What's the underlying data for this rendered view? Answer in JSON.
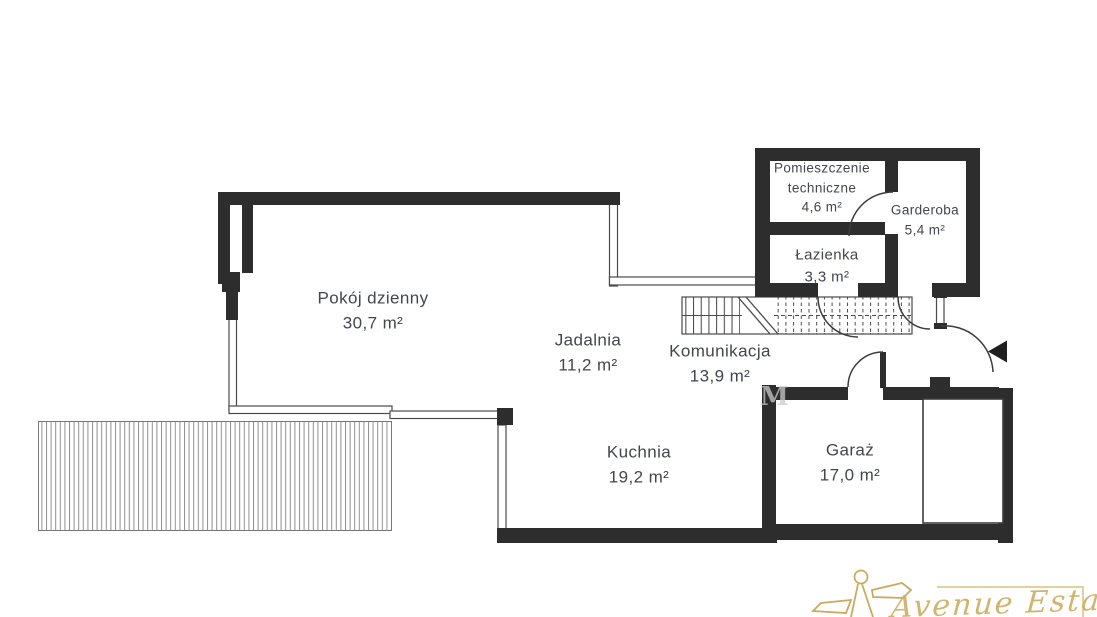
{
  "plan": {
    "rooms": [
      {
        "name": "Pokój dzienny",
        "area": "30,7 m²"
      },
      {
        "name": "Jadalnia",
        "area": "11,2 m²"
      },
      {
        "name": "Komunikacja",
        "area": "13,9 m²"
      },
      {
        "name": "Kuchnia",
        "area": "19,2 m²"
      },
      {
        "name": "Garaż",
        "area": "17,0 m²"
      },
      {
        "name": "Pomieszczenie techniczne",
        "area": "4,6 m²"
      },
      {
        "name": "Garderoba",
        "area": "5,4 m²"
      },
      {
        "name": "Łazienka",
        "area": "3,3 m²"
      }
    ],
    "features": {
      "stairs": "staircase with break line and dashed upper flight",
      "terrace": "hatched deck / terrace",
      "entrance_arrow": "main entrance direction arrow",
      "garage_gate": "garage door panel"
    },
    "watermark_ghost": "M",
    "colors": {
      "wall": "#2d2d2d",
      "thin_line": "#4a4a4a",
      "hatch": "#8f8f8f",
      "label_text": "#42464d",
      "logo_gold": "#d0b169",
      "background": "#ffffff"
    }
  },
  "branding": {
    "agency_name": "Avenue Estate"
  }
}
